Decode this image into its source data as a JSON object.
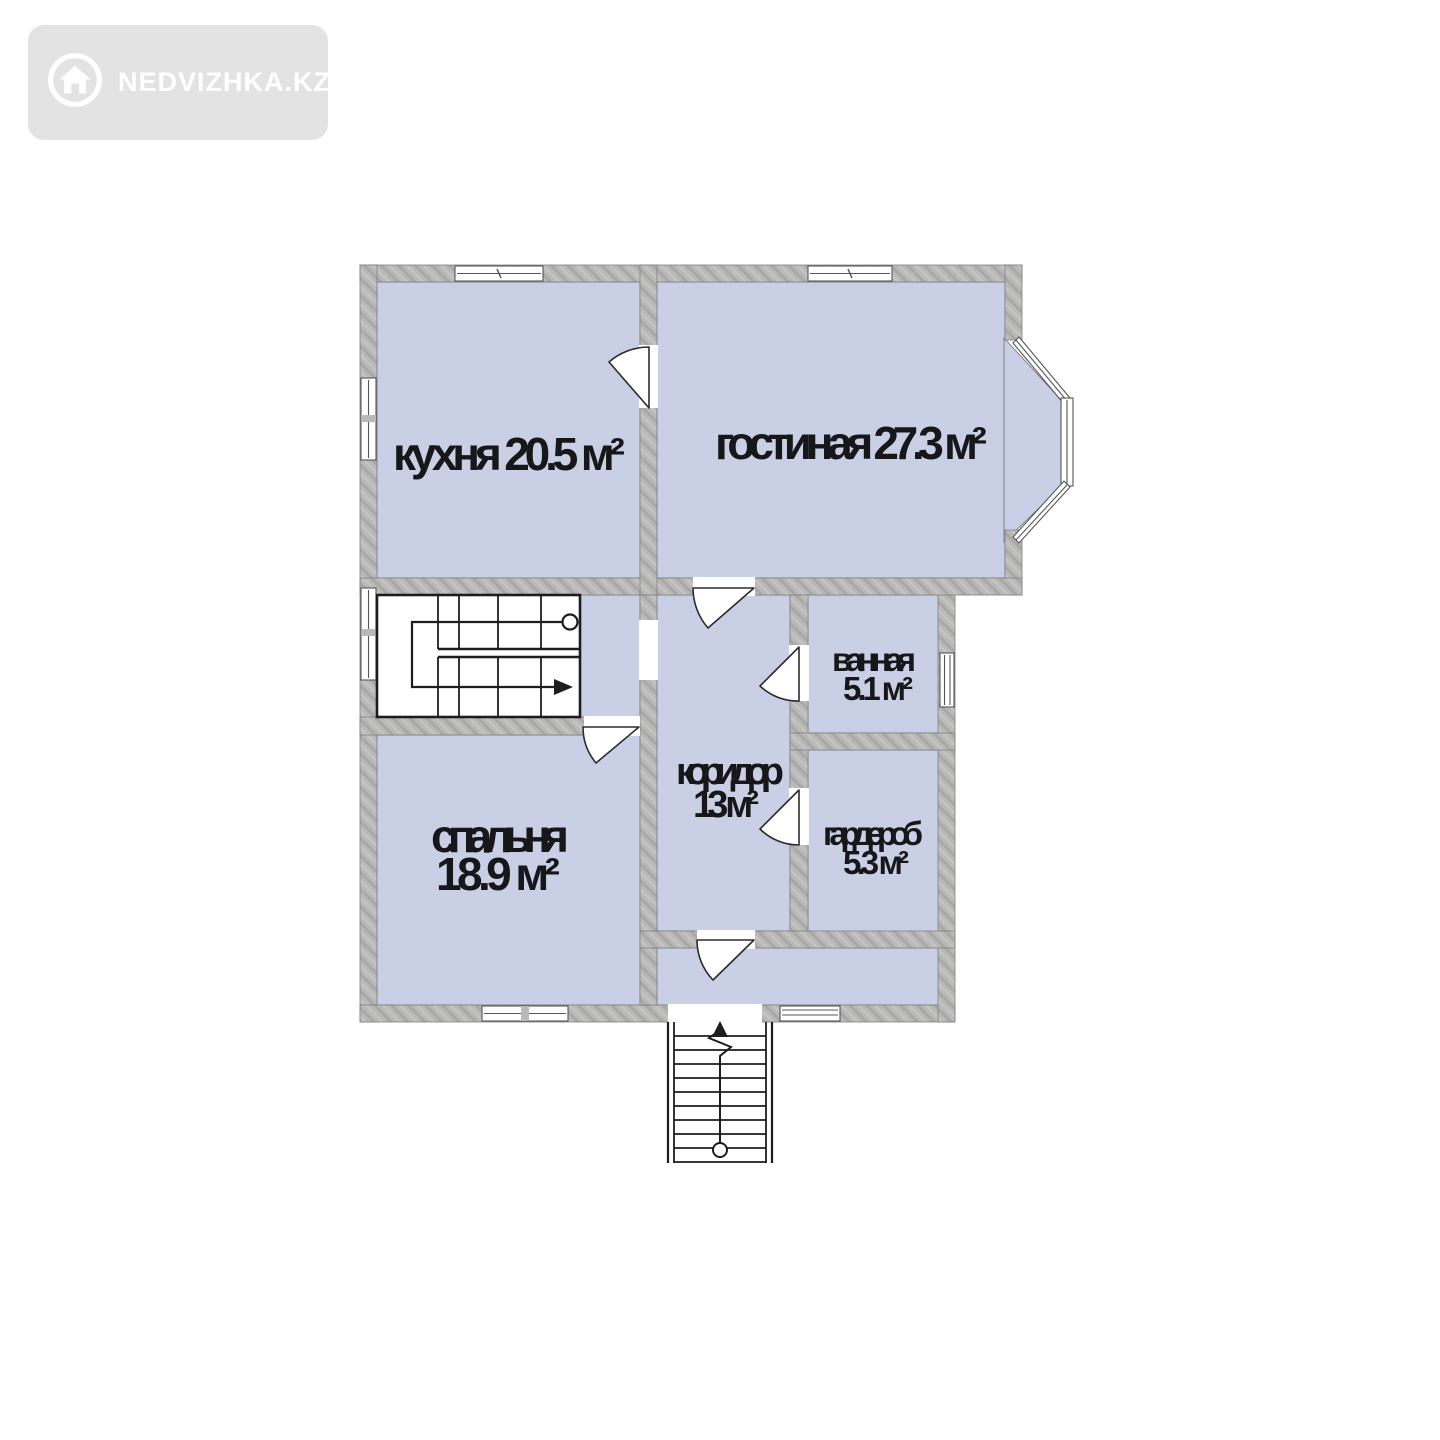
{
  "watermark": {
    "brand": "NEDVIZHKA.KZ",
    "icon": "house-icon",
    "badge_color": "#e3e3e3",
    "text_color": "#ffffff"
  },
  "floor_plan": {
    "rooms": {
      "kitchen": {
        "label": "кухня 20.5 м²"
      },
      "living": {
        "label": "гостиная 27.3 м²"
      },
      "bathroom": {
        "name": "ванная",
        "area": "5.1 м²"
      },
      "corridor": {
        "name": "коридор",
        "area": "13 м²"
      },
      "wardrobe": {
        "name": "гардероб",
        "area": "5.3 м²"
      },
      "bedroom": {
        "name": "спальня",
        "area": "18.9 м²"
      }
    },
    "features": [
      "interior-staircase",
      "exterior-entrance-staircase",
      "bay-window"
    ],
    "colors": {
      "room_fill": "#c9cfe5",
      "wall_fill": "#b9b9b8",
      "stair_fill": "#ffffff",
      "line": "#222222",
      "label_text": "#17171a",
      "page_background": "#ffffff"
    }
  }
}
